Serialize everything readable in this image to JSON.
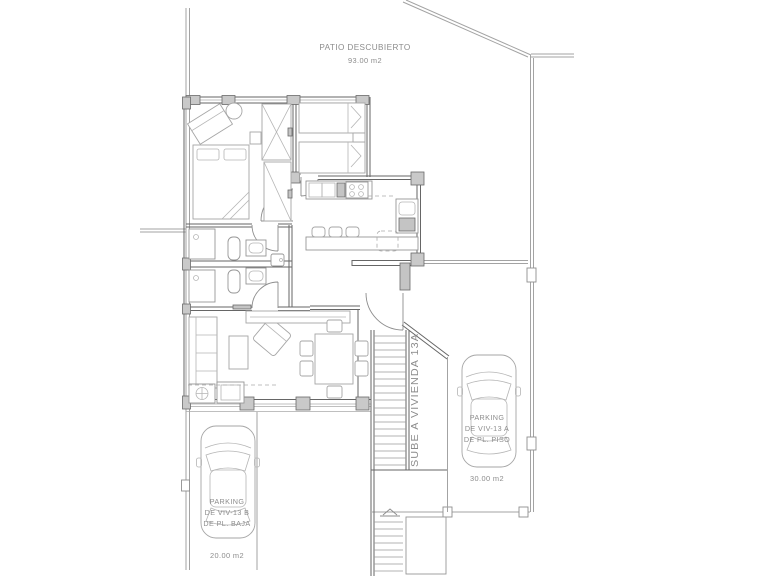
{
  "plan": {
    "patio": {
      "title": "PATIO DESCUBIERTO",
      "area": "93.00 m2"
    },
    "stair_note": "SUBE A VIVIENDA 13A",
    "parking_left": {
      "line1": "PARKING",
      "line2": "DE VIV-13 B",
      "line3": "DE PL. BAJA",
      "area": "20.00 m2"
    },
    "parking_right": {
      "line1": "PARKING",
      "line2": "DE VIV-13 A",
      "line3": "DE PL. PISO",
      "area": "30.00 m2"
    },
    "colors": {
      "background": "#ffffff",
      "boundary_line": "#a3a3a3",
      "wall_line": "#666666",
      "furniture_line": "#a6a6a6",
      "label_text": "#8c8c8c",
      "column_fill": "#c9c9c9"
    }
  }
}
